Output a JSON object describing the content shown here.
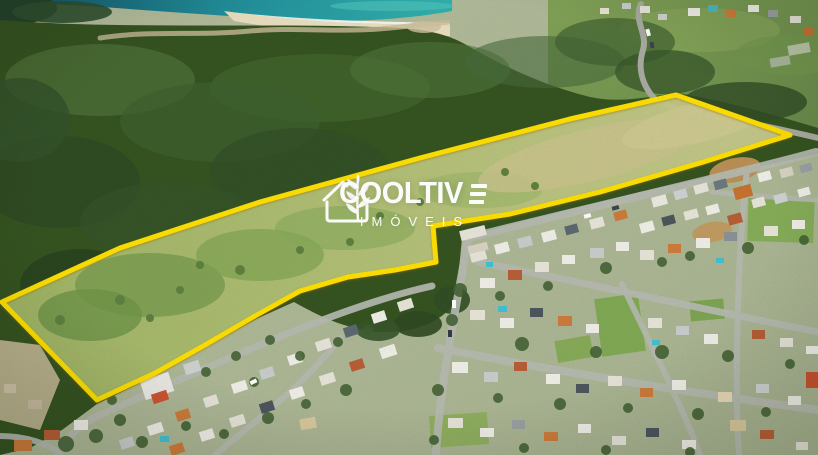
{
  "image": {
    "kind": "aerial drone photograph",
    "width_px": 818,
    "height_px": 455,
    "description": "Aerial view of a large grass land parcel outlined in yellow, between a dark forested coastal hill with ocean and beach at top, and a dense residential neighborhood below right"
  },
  "watermark": {
    "logo_icon": "house-with-wheat-icon",
    "brand_display": "COOLTIV",
    "brand_last_letter_stylized": "E",
    "brand_full": "COOLTIVE",
    "subtitle": "IMÓVEIS",
    "text_color": "#ffffff"
  },
  "parcel": {
    "outline_color": "#ffe000",
    "outline_width_px": 5,
    "shape": "elongated irregular polygon with rectangular notch at lower middle",
    "fill_appearance": "light yellow-green grass field"
  },
  "scene": {
    "ocean_color": "#1f8d9b",
    "beach_color": "#eadfc0",
    "forest_color": "#33511f",
    "field_color": "#b7c478",
    "street_color": "#b7bab2",
    "features": [
      "ocean",
      "beach with surf",
      "sandy trail",
      "coastal forest hill",
      "winding road",
      "highlighted grass parcel",
      "residential neighborhood",
      "streets",
      "houses",
      "swimming pools"
    ]
  }
}
